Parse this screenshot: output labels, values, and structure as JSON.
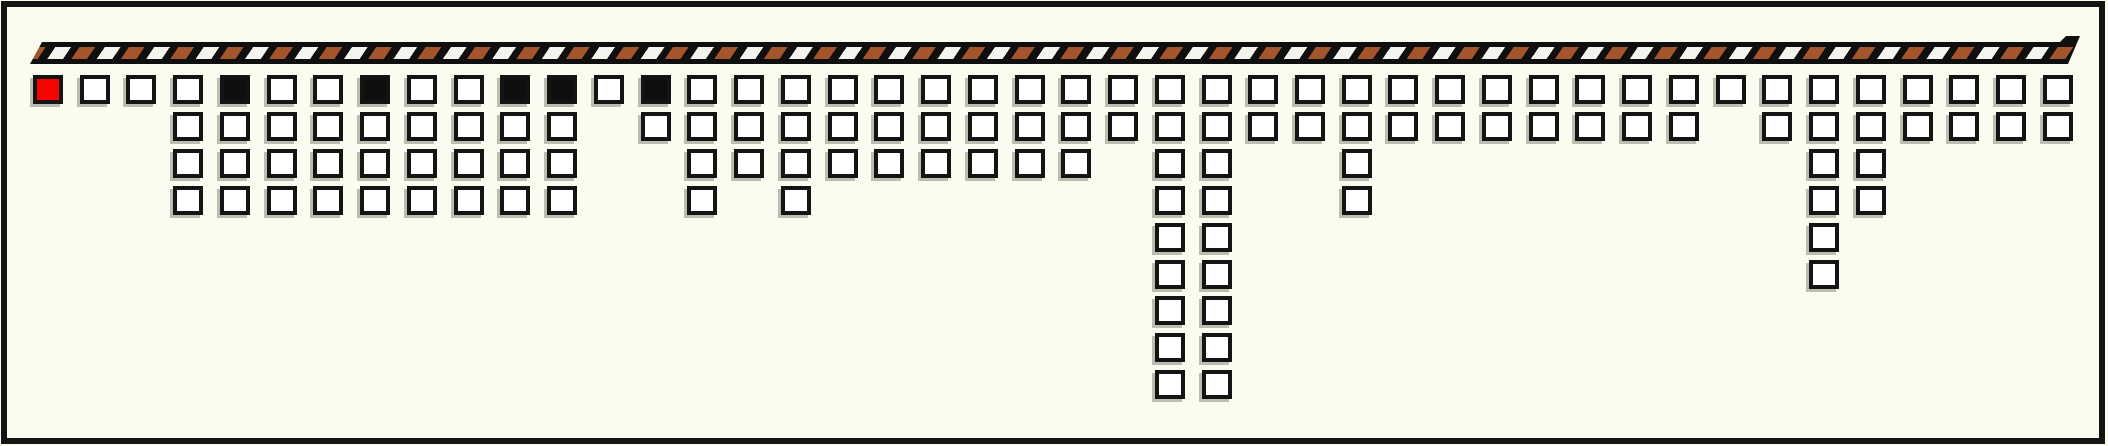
{
  "board": {
    "column_counts": [
      1,
      1,
      1,
      4,
      4,
      4,
      4,
      4,
      4,
      4,
      4,
      4,
      1,
      2,
      4,
      3,
      4,
      3,
      3,
      3,
      3,
      3,
      3,
      2,
      9,
      9,
      2,
      2,
      4,
      2,
      2,
      2,
      2,
      2,
      2,
      2,
      1,
      2,
      6,
      4,
      2,
      2,
      2,
      2
    ],
    "red_columns": [
      1
    ],
    "black_columns": [
      5,
      8,
      11,
      12,
      14
    ],
    "total_columns": 44,
    "total_squares": 134
  },
  "colors": {
    "background": "#fbfbf0",
    "frame": "#141414",
    "square_border": "#141414",
    "square_fill": "#ffffff",
    "square_red": "#f60400",
    "square_black": "#0f0f0f",
    "ribbon_base": "#0f0f0f",
    "ribbon_stripe_brown": "#a5552b",
    "ribbon_stripe_white": "#f4f4ee"
  }
}
